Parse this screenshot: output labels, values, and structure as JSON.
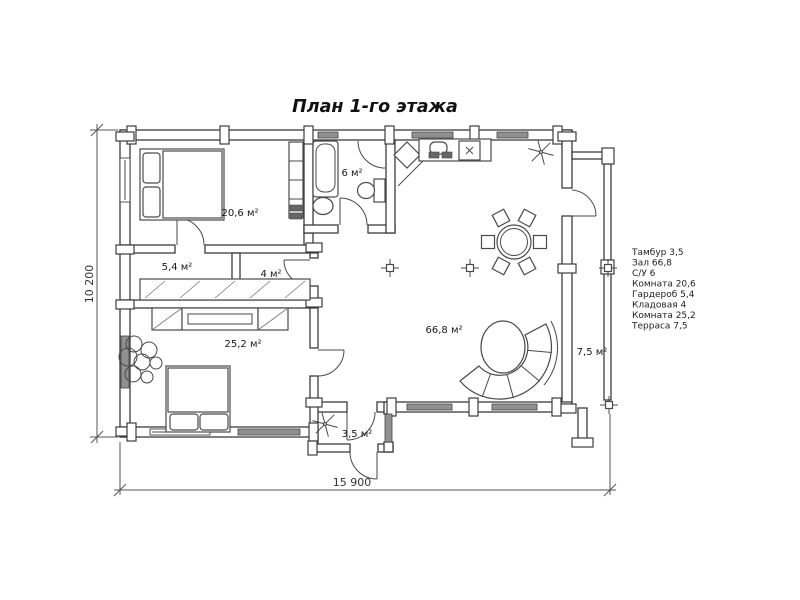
{
  "title": "План 1-го этажа",
  "rooms": {
    "bedroom1": "20,6 м²",
    "bathroom": "6 м²",
    "dressing": "5,4 м²",
    "storage": "4 м²",
    "bedroom2": "25,2 м²",
    "hall": "66,8 м²",
    "vestibule": "3,5 м²",
    "terrace": "7,5 м²"
  },
  "legend": {
    "items": [
      "Тамбур 3,5",
      "Зал 66,8",
      "С/У 6",
      "Комната 20,6",
      "Гардероб 5,4",
      "Кладовая 4",
      "Комната 25,2",
      "Терраса 7,5"
    ]
  },
  "dimensions": {
    "width": "15 900",
    "height": "10 200"
  },
  "colors": {
    "line": "#3c3c3c",
    "window_fill": "#909090",
    "background": "#ffffff",
    "text": "#1a1a1a"
  }
}
